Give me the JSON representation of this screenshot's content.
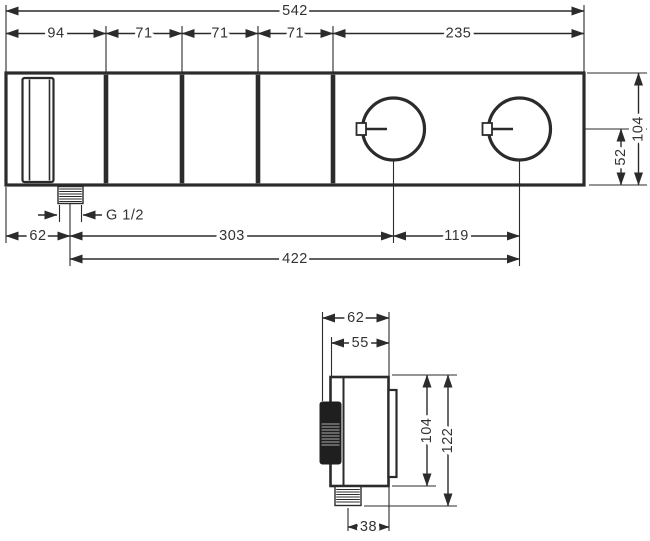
{
  "front_view": {
    "total_width": "542",
    "segment_widths": [
      "94",
      "71",
      "71",
      "71",
      "235"
    ],
    "total_height": "104",
    "handle_axis_to_bottom": "52",
    "thread_label": "G 1/2",
    "left_edge_to_inlet": "62",
    "inlet_to_handle1": "303",
    "handle1_to_handle2": "119",
    "inlet_to_handle2": "422"
  },
  "side_view": {
    "total_depth": "62",
    "body_depth": "55",
    "body_height": "104",
    "total_height": "122",
    "inlet_axis_to_front": "38"
  },
  "colors": {
    "line": "#2b2b2b",
    "text": "#333333",
    "background": "#ffffff"
  }
}
